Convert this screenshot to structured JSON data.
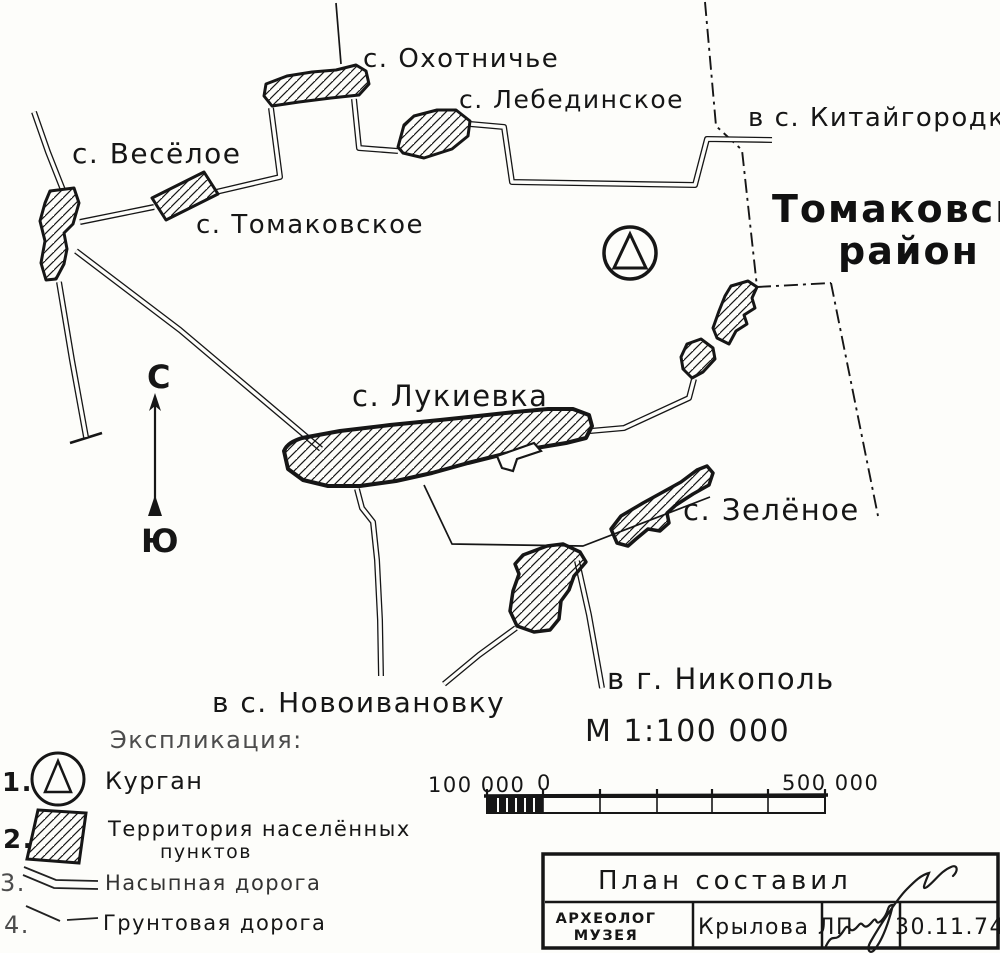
{
  "map": {
    "region_title": {
      "line1": "Томаковский",
      "line2": "район"
    },
    "labels": {
      "okhotnichye": "с. Охотничье",
      "lebedinskoye": "с. Лебединское",
      "kitaygorodka": "в с. Китайгородку",
      "vesyoloye": "с. Весёлое",
      "tomakovskoye": "с. Томаковское",
      "lukievka": "с. Лукиевка",
      "zelyonoye": "с. Зелёное",
      "nikopol": "в г. Никополь",
      "novoivanovka": "в с. Новоивановку"
    },
    "compass": {
      "north": "С",
      "south": "Ю"
    },
    "scale_text": "М 1:100 000"
  },
  "legend": {
    "heading": "Экспликация:",
    "items": [
      {
        "num": "1.",
        "label": "Курган",
        "symbol": "kurgan-circle-triangle"
      },
      {
        "num": "2.",
        "label_line1": "Территория населённых",
        "label_line2": "пунктов",
        "symbol": "hatched-area"
      },
      {
        "num": "3.",
        "label": "Насыпная дорога",
        "symbol": "double-line-road"
      },
      {
        "num": "4.",
        "label": "Грунтовая дорога",
        "symbol": "single-line-road"
      }
    ]
  },
  "scale_bar": {
    "left_label": "100 000",
    "zero_label": "0",
    "right_label": "500 000"
  },
  "title_block": {
    "title": "План составил",
    "role_line1": "АРХЕОЛОГ",
    "role_line2": "МУЗЕЯ",
    "name": "Крылова ЛП",
    "date": "30.11.74"
  },
  "colors": {
    "ink": "#161616",
    "paper": "#fdfdfa"
  }
}
